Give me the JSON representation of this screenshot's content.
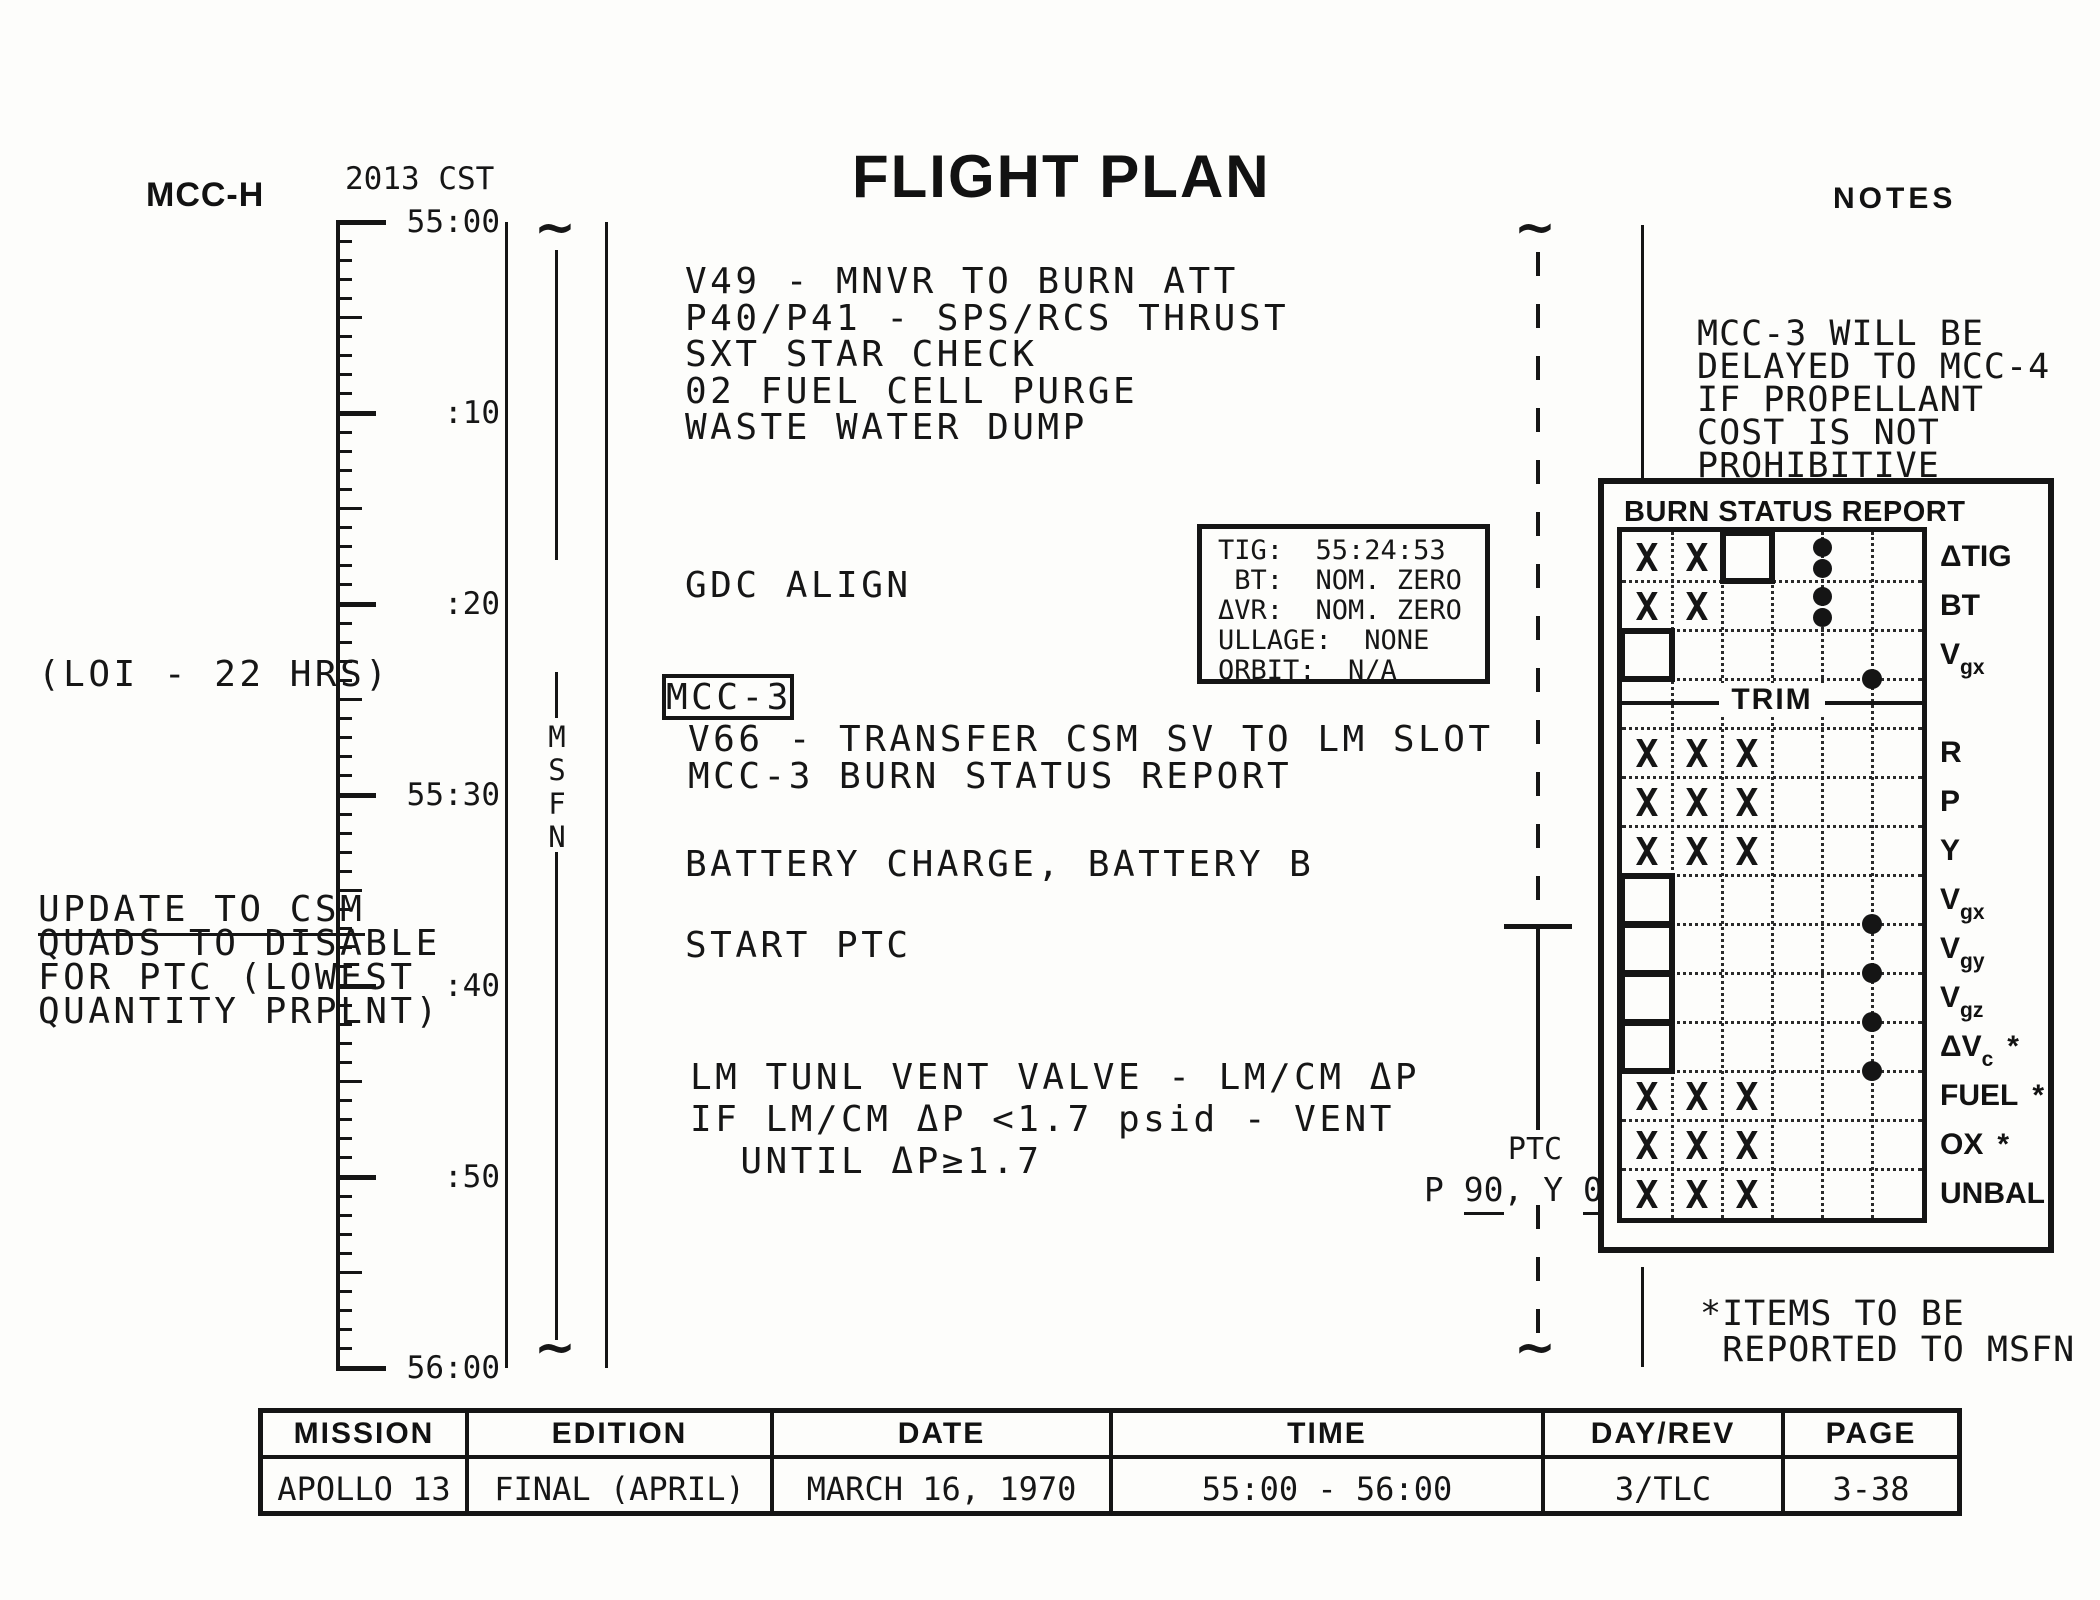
{
  "header": {
    "mcc_label": "MCC-H",
    "cst_label": "2013 CST",
    "title": "FLIGHT PLAN",
    "notes_label": "NOTES"
  },
  "timeline": {
    "msfn": "MSFN",
    "labels": [
      {
        "text": "55:00",
        "min": 0
      },
      {
        "text": ":10",
        "min": 10
      },
      {
        "text": ":20",
        "min": 20
      },
      {
        "text": "55:30",
        "min": 30
      },
      {
        "text": ":40",
        "min": 40
      },
      {
        "text": ":50",
        "min": 50
      },
      {
        "text": "56:00",
        "min": 60
      }
    ]
  },
  "left_margin": {
    "loi_note": "(LOI - 22 HRS)",
    "update_note_lines": [
      "UPDATE TO CSM",
      "QUADS TO DISABLE",
      "FOR PTC (LOWEST",
      "QUANTITY PRPLNT)"
    ]
  },
  "activities": {
    "block1": [
      "V49 - MNVR TO BURN ATT",
      "P40/P41 - SPS/RCS THRUST",
      "SXT STAR CHECK",
      "02 FUEL CELL PURGE",
      "WASTE WATER DUMP"
    ],
    "gdc_align": "GDC ALIGN",
    "mcc3_flag": "MCC-3",
    "block2": [
      "V66 - TRANSFER CSM SV TO LM SLOT",
      "MCC-3 BURN STATUS REPORT"
    ],
    "battery": "BATTERY CHARGE, BATTERY B",
    "start_ptc": "START PTC",
    "lm_vent_lines": [
      "LM TUNL VENT VALVE - LM/CM ΔP",
      "IF LM/CM ΔP <1.7 psid - VENT",
      "  UNTIL ΔP≥1.7"
    ]
  },
  "tig_box": {
    "lines": [
      "TIG:  55:24:53",
      " BT:  NOM. ZERO",
      "ΔVR:  NOM. ZERO",
      "ULLAGE:  NONE",
      "ORBIT:  N/A"
    ]
  },
  "ptc_marker": {
    "label": "PTC",
    "attitude_parts": [
      {
        "t": "P "
      },
      {
        "t": "90",
        "u": true
      },
      {
        "t": ", Y "
      },
      {
        "t": "0",
        "u": true
      }
    ]
  },
  "notes_column": {
    "note_lines": [
      "MCC-3 WILL BE",
      "DELAYED TO MCC-4",
      "IF PROPELLANT",
      "COST IS NOT",
      "PROHIBITIVE"
    ],
    "footnote_lines": [
      "*ITEMS TO BE",
      " REPORTED TO MSFN"
    ]
  },
  "burn_status_report": {
    "title": "BURN STATUS REPORT",
    "rows": [
      {
        "label": "ΔTIG",
        "x_marks": [
          1,
          2
        ],
        "box_col": 3,
        "dot_pair": true
      },
      {
        "label": "BT",
        "x_marks": [
          1,
          2
        ],
        "dot_pair": true
      },
      {
        "label": "V",
        "sub": "gx",
        "box_col": 1,
        "dot_bottom": true
      },
      {
        "divider": true,
        "label": "TRIM"
      },
      {
        "label": "R",
        "x_marks": [
          1,
          2,
          3
        ]
      },
      {
        "label": "P",
        "x_marks": [
          1,
          2,
          3
        ]
      },
      {
        "label": "Y",
        "x_marks": [
          1,
          2,
          3
        ]
      },
      {
        "label": "V",
        "sub": "gx",
        "box_col": 1,
        "dot_bottom": true
      },
      {
        "label": "V",
        "sub": "gy",
        "box_col": 1,
        "dot_bottom": true
      },
      {
        "label": "V",
        "sub": "gz",
        "box_col": 1,
        "dot_bottom": true
      },
      {
        "label": "ΔV",
        "sub": "c",
        "star": true,
        "box_col": 1,
        "dot_bottom": true
      },
      {
        "label": "FUEL",
        "star": true,
        "x_marks": [
          1,
          2,
          3
        ]
      },
      {
        "label": "OX",
        "star": true,
        "x_marks": [
          1,
          2,
          3
        ]
      },
      {
        "label": "UNBAL",
        "x_marks": [
          1,
          2,
          3
        ]
      }
    ]
  },
  "footer": {
    "columns": [
      {
        "header": "MISSION",
        "value": "APOLLO 13"
      },
      {
        "header": "EDITION",
        "value": "FINAL (APRIL)"
      },
      {
        "header": "DATE",
        "value": "MARCH 16, 1970"
      },
      {
        "header": "TIME",
        "value": "55:00 - 56:00"
      },
      {
        "header": "DAY/REV",
        "value": "3/TLC"
      },
      {
        "header": "PAGE",
        "value": "3-38"
      }
    ]
  }
}
